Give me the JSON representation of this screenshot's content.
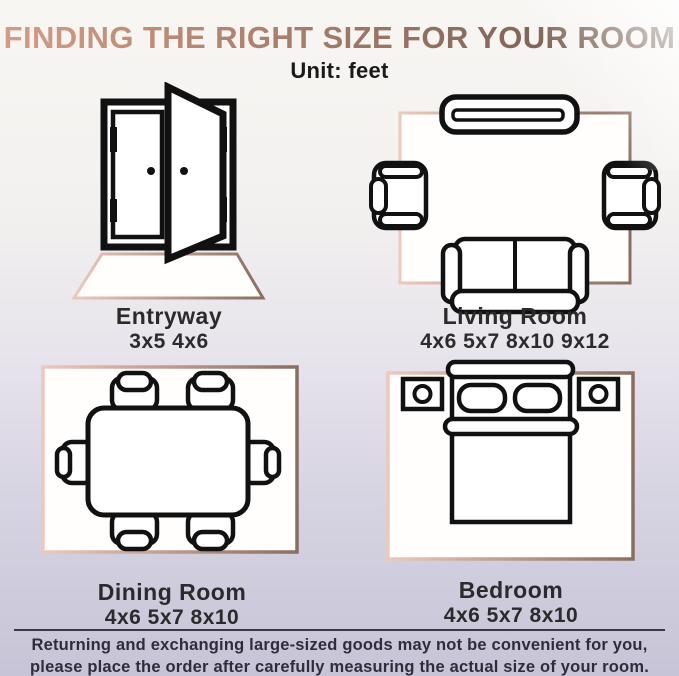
{
  "title": "FINDING THE RIGHT SIZE FOR YOUR ROOM",
  "unit_label": "Unit: feet",
  "rooms": [
    {
      "name": "Entryway",
      "sizes": "3x5 4x6",
      "icon": "double-door-rug-icon"
    },
    {
      "name": "Living Room",
      "sizes": "4x6 5x7 8x10 9x12",
      "icon": "tv-armchairs-sofa-rug-icon"
    },
    {
      "name": "Dining Room",
      "sizes": "4x6 5x7 8x10",
      "icon": "dining-table-six-chairs-rug-icon"
    },
    {
      "name": "Bedroom",
      "sizes": "4x6 5x7 8x10",
      "icon": "bed-nightstands-rug-icon"
    }
  ],
  "disclaimer": {
    "line1": "Returning and exchanging large-sized goods may not be convenient for you,",
    "line2": "please place the order after carefully measuring the actual size of your room."
  },
  "colors": {
    "title_gradient_start": "#d49c85",
    "title_gradient_end": "#6b564a",
    "rug_gradient_start": "#ecc9bc",
    "rug_gradient_end": "#8a6e5f",
    "outline": "#111111",
    "label_text": "#2b2b2b",
    "disclaimer_text": "#2e2e3a",
    "background_top": "#f8f6f3",
    "background_bottom": "#c7c4d7"
  }
}
